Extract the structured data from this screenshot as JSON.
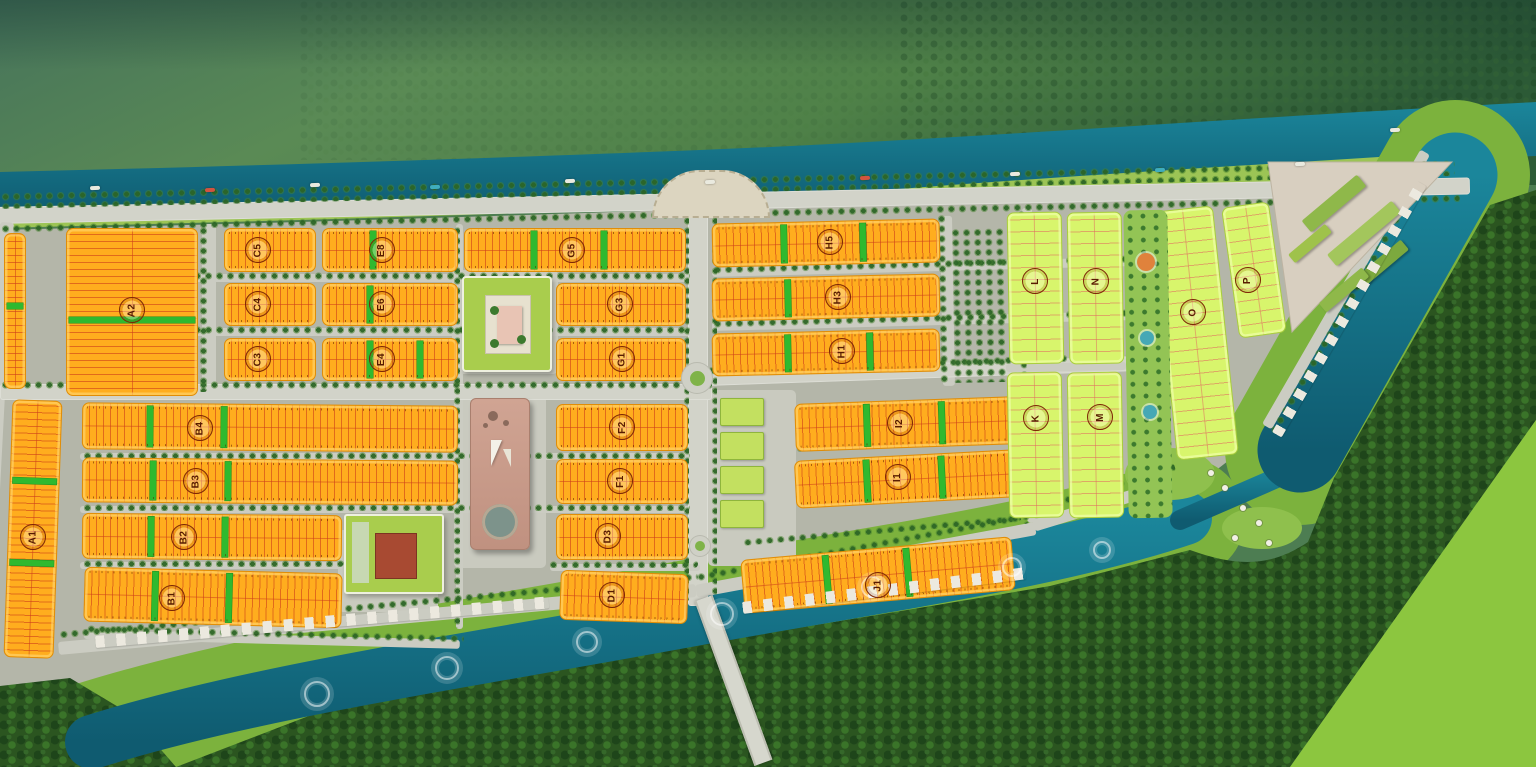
{
  "scene": {
    "width": 1536,
    "height": 767,
    "description_labels_only": true
  },
  "palette": {
    "orange_block": "#ffad1e",
    "orange_border": "#e08d07",
    "plot_line_red": "rgba(205,62,25,0.6)",
    "lime_block": "#d8f56c",
    "lime_border": "#a9ce3e",
    "green_divider": "#2fb92f",
    "road": "#cbccc2",
    "river": "#177c90",
    "canal_deep": "#0f5b70",
    "grass_bank": "#7cb23d",
    "bright_field": "#8cc63f",
    "forest_dark": "#2b5520",
    "shore_grass": "#9cc455",
    "badge_ring": "#7c2604",
    "clubhouse_roof": "#a9cd4d",
    "tower_pink": "#c89a89"
  },
  "badges": [
    {
      "t": "A2",
      "x": 132,
      "y": 310
    },
    {
      "t": "A1",
      "x": 33,
      "y": 537
    },
    {
      "t": "C5",
      "x": 258,
      "y": 250
    },
    {
      "t": "C4",
      "x": 258,
      "y": 304
    },
    {
      "t": "C3",
      "x": 258,
      "y": 359
    },
    {
      "t": "E8",
      "x": 382,
      "y": 250
    },
    {
      "t": "E6",
      "x": 382,
      "y": 304
    },
    {
      "t": "E4",
      "x": 382,
      "y": 359
    },
    {
      "t": "G5",
      "x": 572,
      "y": 250
    },
    {
      "t": "G3",
      "x": 620,
      "y": 304
    },
    {
      "t": "G1",
      "x": 622,
      "y": 359
    },
    {
      "t": "H5",
      "x": 830,
      "y": 242
    },
    {
      "t": "H3",
      "x": 838,
      "y": 297
    },
    {
      "t": "H1",
      "x": 842,
      "y": 351
    },
    {
      "t": "B4",
      "x": 200,
      "y": 428
    },
    {
      "t": "B3",
      "x": 196,
      "y": 481
    },
    {
      "t": "B2",
      "x": 184,
      "y": 537
    },
    {
      "t": "B1",
      "x": 172,
      "y": 598
    },
    {
      "t": "F2",
      "x": 622,
      "y": 427
    },
    {
      "t": "F1",
      "x": 620,
      "y": 481
    },
    {
      "t": "D3",
      "x": 608,
      "y": 536
    },
    {
      "t": "D1",
      "x": 612,
      "y": 595
    },
    {
      "t": "I2",
      "x": 900,
      "y": 423
    },
    {
      "t": "I1",
      "x": 898,
      "y": 477
    },
    {
      "t": "J1",
      "x": 878,
      "y": 585
    },
    {
      "t": "K",
      "x": 1036,
      "y": 418
    },
    {
      "t": "L",
      "x": 1035,
      "y": 281
    },
    {
      "t": "M",
      "x": 1100,
      "y": 417
    },
    {
      "t": "N",
      "x": 1096,
      "y": 281
    },
    {
      "t": "O",
      "x": 1193,
      "y": 312
    },
    {
      "t": "P",
      "x": 1248,
      "y": 280
    }
  ],
  "blocks": [
    {
      "id": "A-strip",
      "type": "orange",
      "orient": "vert",
      "x": 4,
      "y": 233,
      "w": 22,
      "h": 156,
      "rot": 0,
      "divs": [
        0.45
      ]
    },
    {
      "id": "A2",
      "type": "orange",
      "orient": "vert",
      "x": 66,
      "y": 228,
      "w": 132,
      "h": 168,
      "rot": 0,
      "divs": [
        0.53
      ]
    },
    {
      "id": "A1",
      "type": "orange",
      "orient": "vert",
      "x": 8,
      "y": 400,
      "w": 50,
      "h": 258,
      "rot": 2,
      "divs": [
        0.3,
        0.62
      ]
    },
    {
      "id": "C5",
      "type": "orange",
      "orient": "horiz",
      "x": 224,
      "y": 228,
      "w": 92,
      "h": 44,
      "rot": 0,
      "divs": []
    },
    {
      "id": "C4",
      "type": "orange",
      "orient": "horiz",
      "x": 224,
      "y": 283,
      "w": 92,
      "h": 43,
      "rot": 0,
      "divs": []
    },
    {
      "id": "C3",
      "type": "orange",
      "orient": "horiz",
      "x": 224,
      "y": 338,
      "w": 92,
      "h": 43,
      "rot": 0,
      "divs": []
    },
    {
      "id": "E8",
      "type": "orange",
      "orient": "horiz",
      "x": 322,
      "y": 228,
      "w": 136,
      "h": 44,
      "rot": 0,
      "divs": [
        0.35
      ]
    },
    {
      "id": "E6",
      "type": "orange",
      "orient": "horiz",
      "x": 322,
      "y": 283,
      "w": 136,
      "h": 43,
      "rot": 0,
      "divs": [
        0.33
      ]
    },
    {
      "id": "E4",
      "type": "orange",
      "orient": "horiz",
      "x": 322,
      "y": 338,
      "w": 136,
      "h": 43,
      "rot": 0,
      "divs": [
        0.33,
        0.7
      ]
    },
    {
      "id": "G5",
      "type": "orange",
      "orient": "horiz",
      "x": 464,
      "y": 228,
      "w": 222,
      "h": 44,
      "rot": 0,
      "divs": [
        0.3,
        0.62
      ]
    },
    {
      "id": "G3",
      "type": "orange",
      "orient": "horiz",
      "x": 556,
      "y": 283,
      "w": 130,
      "h": 43,
      "rot": 0,
      "divs": []
    },
    {
      "id": "G1",
      "type": "orange",
      "orient": "horiz",
      "x": 556,
      "y": 338,
      "w": 130,
      "h": 43,
      "rot": 0,
      "divs": []
    },
    {
      "id": "H5",
      "type": "orange",
      "orient": "horiz",
      "x": 712,
      "y": 221,
      "w": 228,
      "h": 44,
      "rot": -1.3,
      "divs": [
        0.3,
        0.65
      ]
    },
    {
      "id": "H3",
      "type": "orange",
      "orient": "horiz",
      "x": 712,
      "y": 276,
      "w": 228,
      "h": 43,
      "rot": -1.3,
      "divs": [
        0.32
      ]
    },
    {
      "id": "H1",
      "type": "orange",
      "orient": "horiz",
      "x": 712,
      "y": 331,
      "w": 228,
      "h": 43,
      "rot": -1.3,
      "divs": [
        0.32,
        0.68
      ]
    },
    {
      "id": "B4",
      "type": "orange",
      "orient": "horiz",
      "x": 82,
      "y": 404,
      "w": 376,
      "h": 47,
      "rot": 0.5,
      "divs": [
        0.17,
        0.37
      ]
    },
    {
      "id": "B3",
      "type": "orange",
      "orient": "horiz",
      "x": 82,
      "y": 459,
      "w": 376,
      "h": 45,
      "rot": 0.5,
      "divs": [
        0.18,
        0.38
      ]
    },
    {
      "id": "B2",
      "type": "orange",
      "orient": "horiz",
      "x": 82,
      "y": 514,
      "w": 260,
      "h": 46,
      "rot": 0.5,
      "divs": [
        0.25,
        0.54
      ]
    },
    {
      "id": "B1",
      "type": "orange",
      "orient": "horiz",
      "x": 84,
      "y": 570,
      "w": 258,
      "h": 55,
      "rot": 1.5,
      "divs": [
        0.26,
        0.55
      ]
    },
    {
      "id": "F2",
      "type": "orange",
      "orient": "horiz",
      "x": 556,
      "y": 404,
      "w": 132,
      "h": 47,
      "rot": 0,
      "divs": []
    },
    {
      "id": "F1",
      "type": "orange",
      "orient": "horiz",
      "x": 556,
      "y": 459,
      "w": 132,
      "h": 45,
      "rot": 0,
      "divs": []
    },
    {
      "id": "D3",
      "type": "orange",
      "orient": "horiz",
      "x": 556,
      "y": 514,
      "w": 132,
      "h": 46,
      "rot": 0,
      "divs": []
    },
    {
      "id": "D1",
      "type": "orange",
      "orient": "horiz",
      "x": 560,
      "y": 572,
      "w": 128,
      "h": 50,
      "rot": 2,
      "divs": []
    },
    {
      "id": "I2",
      "type": "orange",
      "orient": "horiz",
      "x": 795,
      "y": 400,
      "w": 222,
      "h": 48,
      "rot": -2,
      "divs": [
        0.31,
        0.65
      ]
    },
    {
      "id": "I1",
      "type": "orange",
      "orient": "horiz",
      "x": 795,
      "y": 455,
      "w": 222,
      "h": 48,
      "rot": -3,
      "divs": [
        0.31,
        0.65
      ]
    },
    {
      "id": "J1",
      "type": "orange",
      "orient": "horiz",
      "x": 742,
      "y": 548,
      "w": 272,
      "h": 54,
      "rot": -5,
      "divs": [
        0.3,
        0.6
      ]
    },
    {
      "id": "L",
      "type": "lime",
      "orient": "vert",
      "x": 1008,
      "y": 212,
      "w": 55,
      "h": 152,
      "rot": -1,
      "divs": []
    },
    {
      "id": "N",
      "type": "lime",
      "orient": "vert",
      "x": 1068,
      "y": 212,
      "w": 55,
      "h": 152,
      "rot": -1,
      "divs": []
    },
    {
      "id": "K",
      "type": "lime",
      "orient": "vert",
      "x": 1008,
      "y": 372,
      "w": 55,
      "h": 146,
      "rot": -1,
      "divs": []
    },
    {
      "id": "M",
      "type": "lime",
      "orient": "vert",
      "x": 1068,
      "y": 372,
      "w": 55,
      "h": 146,
      "rot": -1,
      "divs": []
    },
    {
      "id": "O",
      "type": "lime",
      "orient": "vert",
      "x": 1164,
      "y": 208,
      "w": 62,
      "h": 250,
      "rot": -6,
      "divs": []
    },
    {
      "id": "P",
      "type": "lime",
      "orient": "vert",
      "x": 1230,
      "y": 204,
      "w": 48,
      "h": 132,
      "rot": -8,
      "divs": []
    }
  ],
  "roads": [
    [
      -5,
      207,
      1475,
      17,
      -1.15,
      1
    ],
    [
      0,
      222,
      14,
      468,
      3,
      0
    ],
    [
      202,
      224,
      14,
      168,
      0,
      0
    ],
    [
      456,
      224,
      7,
      405,
      0,
      0
    ],
    [
      688,
      206,
      20,
      400,
      0,
      1
    ],
    [
      940,
      216,
      12,
      170,
      -1,
      0
    ],
    [
      1022,
      208,
      10,
      315,
      -1,
      0
    ],
    [
      0,
      384,
      712,
      16,
      0,
      1
    ],
    [
      706,
      371,
      465,
      15,
      -2,
      1
    ],
    [
      80,
      274,
      610,
      8,
      0,
      0
    ],
    [
      80,
      328,
      610,
      8,
      0,
      0
    ],
    [
      80,
      453,
      610,
      7,
      0,
      0
    ],
    [
      80,
      506,
      610,
      7,
      0,
      0
    ],
    [
      80,
      562,
      264,
      7,
      0,
      0
    ],
    [
      550,
      564,
      150,
      7,
      0,
      0
    ],
    [
      84,
      630,
      376,
      9,
      1.5,
      0
    ],
    [
      712,
      268,
      455,
      9,
      -1.5,
      0
    ],
    [
      712,
      322,
      455,
      9,
      -1.5,
      0
    ],
    [
      58,
      642,
      640,
      13,
      -5.2,
      0
    ],
    [
      695,
      585,
      345,
      13,
      -10.5,
      0
    ],
    [
      1032,
      520,
      140,
      12,
      -17,
      0
    ],
    [
      1262,
      424,
      317,
      11,
      -60,
      0
    ],
    [
      1006,
      364,
      120,
      8,
      -1,
      0
    ]
  ],
  "treelines": [
    [
      0,
      192,
      1455,
      17,
      -1.3
    ],
    [
      0,
      224,
      1460,
      11,
      -1.2
    ],
    [
      82,
      271,
      608,
      9,
      0
    ],
    [
      82,
      325,
      608,
      9,
      0
    ],
    [
      82,
      451,
      608,
      8,
      0
    ],
    [
      82,
      503,
      608,
      8,
      0
    ],
    [
      82,
      559,
      262,
      8,
      0
    ],
    [
      548,
      560,
      150,
      8,
      0
    ],
    [
      86,
      624,
      378,
      10,
      1.5
    ],
    [
      712,
      265,
      452,
      9,
      -1.5
    ],
    [
      712,
      319,
      452,
      9,
      -1.5
    ],
    [
      795,
      444,
      225,
      8,
      -2.5
    ],
    [
      742,
      538,
      280,
      8,
      -5
    ],
    [
      0,
      380,
      712,
      11,
      0
    ],
    [
      706,
      366,
      462,
      11,
      -2
    ],
    [
      198,
      226,
      10,
      166,
      0
    ],
    [
      452,
      226,
      8,
      402,
      0
    ],
    [
      682,
      206,
      7,
      396,
      0
    ],
    [
      710,
      206,
      7,
      392,
      0
    ],
    [
      936,
      214,
      9,
      170,
      -1
    ],
    [
      1016,
      210,
      8,
      314,
      -1
    ],
    [
      950,
      228,
      55,
      155,
      -1
    ],
    [
      58,
      630,
      642,
      10,
      -5.2
    ],
    [
      695,
      573,
      347,
      10,
      -10.5
    ],
    [
      1030,
      506,
      150,
      10,
      -17
    ],
    [
      1268,
      432,
      300,
      10,
      -60
    ]
  ],
  "pads": [
    [
      452,
      270,
      106,
      104
    ],
    [
      454,
      392,
      92,
      176
    ],
    [
      708,
      390,
      88,
      176
    ],
    [
      338,
      530,
      100,
      82
    ]
  ],
  "buildings": {
    "clubhouse": [
      462,
      276,
      86,
      92
    ],
    "tower": [
      470,
      398,
      58,
      150
    ],
    "campus": [
      344,
      514,
      96,
      76
    ],
    "villas": [
      [
        720,
        398,
        42,
        26
      ],
      [
        720,
        432,
        42,
        26
      ],
      [
        720,
        466,
        42,
        26
      ],
      [
        720,
        500,
        42,
        26
      ]
    ],
    "park": [
      1126,
      210,
      44,
      308
    ],
    "park_features": [
      [
        1146,
        262,
        9,
        "#e0823c"
      ],
      [
        1147,
        338,
        7,
        "#46a8b5"
      ],
      [
        1150,
        412,
        7,
        "#46a8b5"
      ]
    ],
    "plaza": [
      652,
      170,
      118,
      48
    ],
    "triangle_pad": "1268,162 1452,162 1292,332",
    "triangle_roofs": [
      [
        1298,
        196,
        72,
        15,
        -40,
        "#8fb84a"
      ],
      [
        1322,
        226,
        84,
        15,
        -40,
        "#a3c65c"
      ],
      [
        1350,
        258,
        62,
        13,
        -40,
        "#7ca93e"
      ],
      [
        1286,
        238,
        48,
        11,
        -40,
        "#9fc24b"
      ],
      [
        1316,
        284,
        56,
        12,
        -40,
        "#8fb84a"
      ]
    ]
  },
  "bridge": [
    724,
    593,
    15,
    175,
    -20
  ],
  "roundabouts": [
    [
      697,
      378,
      30
    ],
    [
      700,
      546,
      20
    ]
  ],
  "huts": [
    [
      95,
      636,
      455,
      12,
      -5
    ],
    [
      742,
      602,
      285,
      12,
      -7
    ],
    [
      1272,
      432,
      290,
      11,
      -60
    ]
  ],
  "fountains": [
    [
      315,
      692,
      22
    ],
    [
      445,
      666,
      20
    ],
    [
      585,
      640,
      18
    ],
    [
      720,
      612,
      20
    ],
    [
      870,
      585,
      18
    ],
    [
      1010,
      565,
      16
    ],
    [
      1100,
      548,
      14
    ]
  ],
  "umbrellas": [
    [
      1208,
      470
    ],
    [
      1222,
      485
    ],
    [
      1240,
      505
    ],
    [
      1256,
      520
    ],
    [
      1232,
      535
    ],
    [
      1266,
      540
    ]
  ],
  "boats": [
    [
      90,
      186,
      "#eaeadf"
    ],
    [
      205,
      188,
      "#d2543f"
    ],
    [
      310,
      183,
      "#eaeadf"
    ],
    [
      430,
      185,
      "#3fadbd"
    ],
    [
      565,
      179,
      "#eaeadf"
    ],
    [
      705,
      180,
      "#eaeadf"
    ],
    [
      860,
      176,
      "#d2543f"
    ],
    [
      1010,
      172,
      "#eaeadf"
    ],
    [
      1155,
      168,
      "#3fadbd"
    ],
    [
      1295,
      162,
      "#eaeadf"
    ],
    [
      1390,
      128,
      "#eaeadf"
    ]
  ],
  "scenery": {
    "river": "M0,172 C250,166 500,158 700,150 C950,140 1200,120 1536,102 L1536,156 C1250,166 1000,178 700,206 C500,214 250,218 0,214 Z",
    "shore": "M0,214 C250,218 500,214 700,206 C1000,178 1250,166 1455,152 L1460,168 L1160,190 C1000,196 700,208 300,220 L0,228 Z",
    "land": "M0,230 L300,222 C700,210 1000,198 1160,192 L1440,168 L1268,430 L1188,492 C1065,535 900,572 700,592 C450,636 250,662 95,712 L0,724 Z",
    "canal_bottom": "M92,742 C250,692 450,664 700,618 C900,582 1060,560 1185,518",
    "canal_right": "M1455,175 L1300,450",
    "canal_link": "M1180,520 L1295,470",
    "forest_main": "M176,767 L340,704 C610,658 850,620 1050,586 L1190,550 C1240,568 1272,566 1308,542 L1334,478 L1490,205 L1536,190 L1536,420 L1290,767 Z",
    "forest_corner": "M0,686 L70,678 L130,714 L176,767 L0,767 Z",
    "field": "M1290,767 L1536,420 L1536,767 Z",
    "peninsula1": "M1170,498 m-45,-24 a45,26 0 1 0 90,0 a45,26 0 1 0 -90,0",
    "peninsula2": "M1262,548 m-40,-20 a40,21 0 1 0 80,0 a40,21 0 1 0 -80,0"
  }
}
